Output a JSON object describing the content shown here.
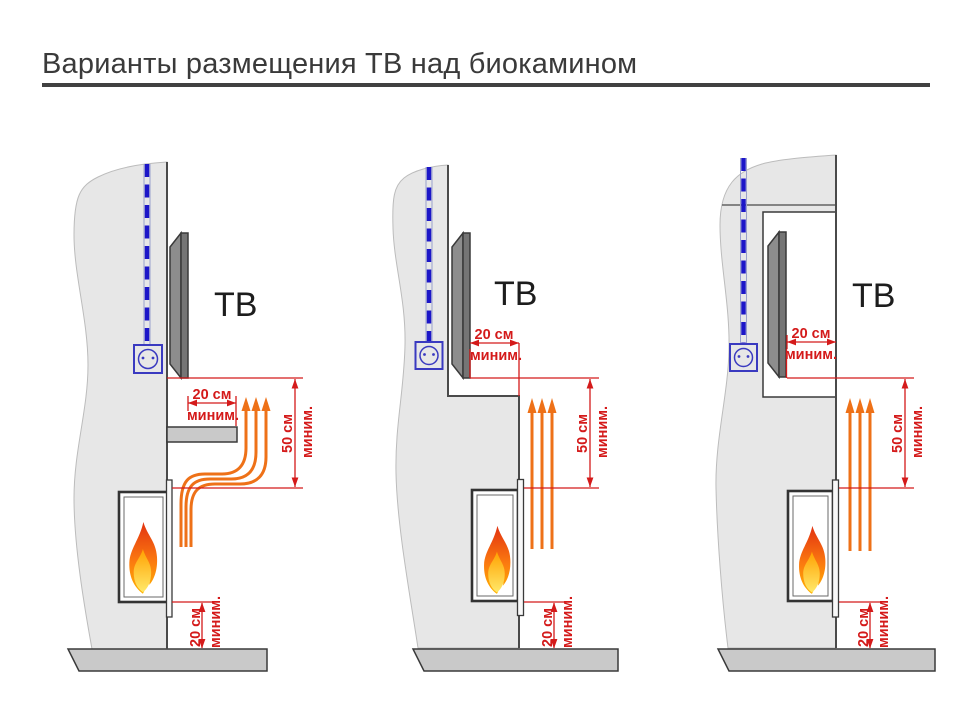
{
  "title": "Варианты размещения ТВ над биокамином",
  "colors": {
    "dimension_red": "#d41a1a",
    "airflow_orange": "#ee7118",
    "cable_blue": "#1c16c8",
    "wall_gray": "#e7e7e7",
    "ledge_gray": "#c9c9c9",
    "tv_dark_gray": "#757575"
  },
  "diagrams": [
    {
      "variant": "tv-on-wall-with-protective-shelf",
      "tv_label": "ТВ",
      "shelf_depth": {
        "value": "20 см",
        "qualifier": "миним."
      },
      "tv_to_fireplace_gap": {
        "value": "50 см",
        "qualifier": "миним."
      },
      "fireplace_to_floor_gap": {
        "value": "20 см",
        "qualifier": "миним."
      }
    },
    {
      "variant": "tv-recessed-behind-wall-step",
      "tv_label": "ТВ",
      "recess_depth": {
        "value": "20 см",
        "qualifier": "миним."
      },
      "tv_to_fireplace_gap": {
        "value": "50 см",
        "qualifier": "миним."
      },
      "fireplace_to_floor_gap": {
        "value": "20 см",
        "qualifier": "миним."
      }
    },
    {
      "variant": "tv-in-wall-niche",
      "tv_label": "ТВ",
      "niche_depth": {
        "value": "20 см",
        "qualifier": "миним."
      },
      "tv_to_fireplace_gap": {
        "value": "50 см",
        "qualifier": "миним."
      },
      "fireplace_to_floor_gap": {
        "value": "20 см",
        "qualifier": "миним."
      }
    }
  ]
}
